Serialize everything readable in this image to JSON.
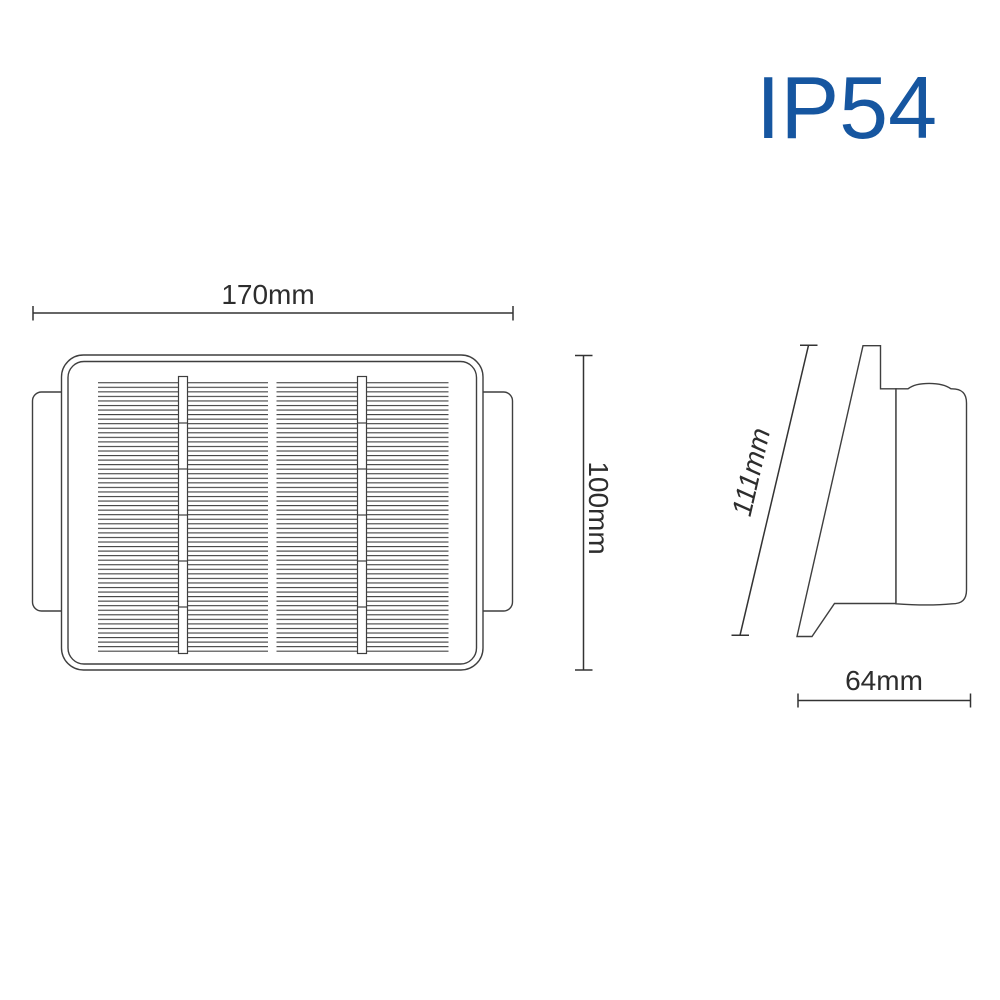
{
  "ip_badge": {
    "label": "IP54",
    "color": "#1656a0"
  },
  "front_view": {
    "width_dim": "170mm",
    "height_dim": "100mm"
  },
  "side_view": {
    "slant_dim": "111mm",
    "depth_dim": "64mm"
  },
  "colors": {
    "line": "#3f3f3f",
    "dimension_line": "#333333",
    "dimension_text": "#2d2d2d",
    "background": "#ffffff"
  }
}
